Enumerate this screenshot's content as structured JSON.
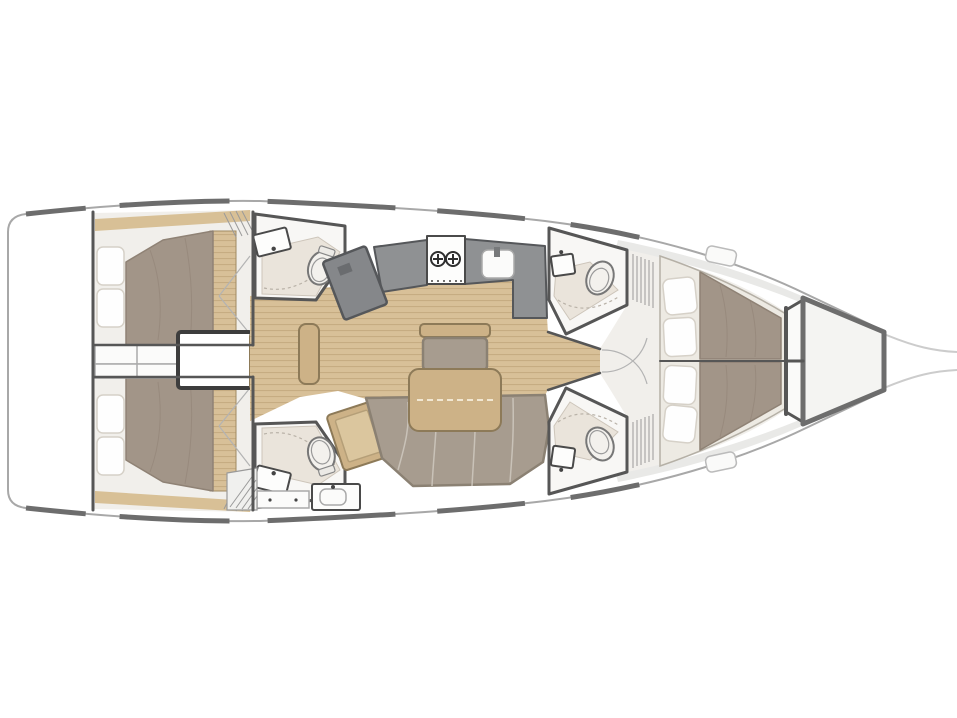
{
  "diagram": {
    "type": "yacht-interior-floorplan",
    "orientation": {
      "bow": "right",
      "stern": "left"
    },
    "visible_text": [],
    "sections": {
      "stern": {
        "name": "transom-and-lazarette",
        "features": [
          "transom-platform",
          "engine-compartment-box",
          "storage-cabinets"
        ]
      },
      "companionway": {
        "name": "companionway",
        "step_count": 4
      },
      "aft_cabins": [
        {
          "name": "aft-cabin-port",
          "bed": {
            "pillow_count": 2,
            "orientation": "athwartships"
          },
          "features": [
            "locker-hatch",
            "wardrobe-doors",
            "wood-slat-foot"
          ]
        },
        {
          "name": "aft-cabin-starboard",
          "bed": {
            "pillow_count": 2,
            "orientation": "athwartships"
          },
          "features": [
            "locker-hatch",
            "wardrobe-doors",
            "wood-slat-foot"
          ]
        }
      ],
      "aft_heads": [
        {
          "name": "aft-head-port",
          "fixtures": [
            "vanity-sink",
            "toilet",
            "shower-floor"
          ]
        },
        {
          "name": "aft-head-starboard",
          "fixtures": [
            "vanity-sink",
            "toilet",
            "shower-floor",
            "second-sink-counter",
            "drawer-unit",
            "step-locker"
          ]
        }
      ],
      "galley": {
        "name": "galley",
        "fixtures": [
          "l-shaped-counter",
          "stove",
          "sink"
        ],
        "stove_burner_count": 2
      },
      "nav_station": {
        "name": "nav-station",
        "fixtures": [
          "gray-desk",
          "wood-chart-table"
        ]
      },
      "salon": {
        "name": "salon",
        "fixtures": [
          "dining-table",
          "u-shaped-settee",
          "forward-bench-seat",
          "side-wood-seat"
        ],
        "flooring": "teak-planks"
      },
      "forward_heads": [
        {
          "name": "forward-head-port",
          "fixtures": [
            "sink",
            "toilet",
            "shower-floor",
            "louvered-locker"
          ]
        },
        {
          "name": "forward-head-starboard",
          "fixtures": [
            "sink",
            "toilet",
            "shower-floor",
            "louvered-locker"
          ]
        }
      ],
      "forward_cabin": {
        "name": "forward-cabin",
        "bed": {
          "pillow_count": 4,
          "type": "v-berth",
          "split_by_centerline": true
        },
        "features": [
          "teak-floor-fan",
          "deck-skylight-hatches"
        ]
      },
      "bow": {
        "name": "bow",
        "features": [
          "chain-locker-compartments",
          "anchor-locker-trapezoid",
          "bow-whisker-lines"
        ]
      }
    }
  },
  "colors": {
    "white": "#ffffff",
    "hull_outline": "#a8a8a8",
    "toe_rail": "#6d6d6d",
    "wall": "#565656",
    "teak": "#d8c098",
    "teak_line": "#c0a47a",
    "wood": "#cdb287",
    "wood_dark": "#8d7a58",
    "mattress": "#a29588",
    "mattress_line": "#8f8275",
    "cushion": "#a79c8f",
    "cushion_line": "#8b8173",
    "cream_wood": "#d8c096",
    "platform": "#edeae3",
    "pillow": "#fefefe",
    "pillow_line": "#d6d1c8",
    "counter": "#8f9193",
    "counter_dark": "#55575a",
    "fixture_line": "#4a4a4a",
    "room_floor": "#f8f7f5",
    "shower": "#eae4db",
    "cabin_floor": "#f1efeb",
    "shade": "#e9e9e7",
    "whisker": "#cccccc"
  }
}
